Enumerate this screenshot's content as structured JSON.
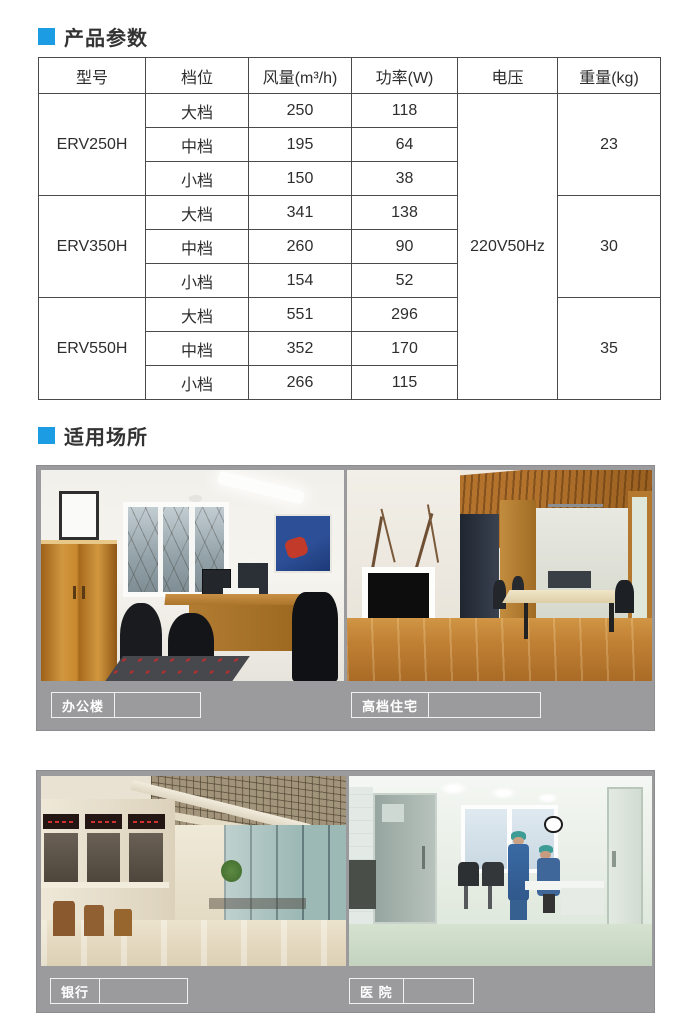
{
  "accent_color": "#1b9ce3",
  "section_product": {
    "title": "产品参数"
  },
  "section_places": {
    "title": "适用场所"
  },
  "spec_table": {
    "headers": [
      "型号",
      "档位",
      "风量(m³/h)",
      "功率(W)",
      "电压",
      "重量(kg)"
    ],
    "voltage": "220V50Hz",
    "models": [
      {
        "name": "ERV250H",
        "weight": "23",
        "rows": [
          {
            "gear": "大档",
            "airflow": "250",
            "power": "118"
          },
          {
            "gear": "中档",
            "airflow": "195",
            "power": "64"
          },
          {
            "gear": "小档",
            "airflow": "150",
            "power": "38"
          }
        ]
      },
      {
        "name": "ERV350H",
        "weight": "30",
        "rows": [
          {
            "gear": "大档",
            "airflow": "341",
            "power": "138"
          },
          {
            "gear": "中档",
            "airflow": "260",
            "power": "90"
          },
          {
            "gear": "小档",
            "airflow": "154",
            "power": "52"
          }
        ]
      },
      {
        "name": "ERV550H",
        "weight": "35",
        "rows": [
          {
            "gear": "大档",
            "airflow": "551",
            "power": "296"
          },
          {
            "gear": "中档",
            "airflow": "352",
            "power": "170"
          },
          {
            "gear": "小档",
            "airflow": "266",
            "power": "115"
          }
        ]
      }
    ]
  },
  "places": [
    {
      "label": "办公楼"
    },
    {
      "label": "高档住宅"
    },
    {
      "label": "银行"
    },
    {
      "label": "医 院"
    }
  ]
}
